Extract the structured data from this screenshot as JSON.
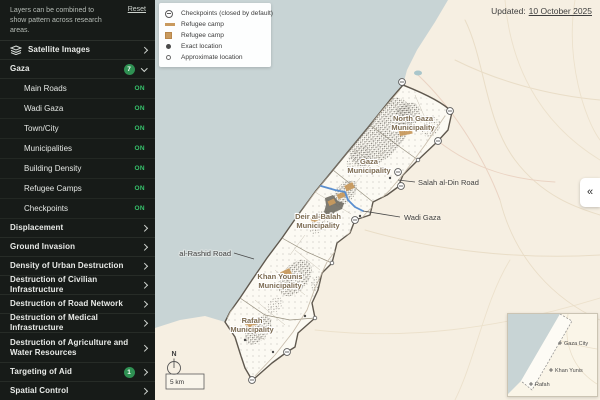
{
  "header": {
    "updated_prefix": "Updated:",
    "updated_date": "10 October 2025"
  },
  "sidebar": {
    "intro": "Layers can be combined to show pattern across research areas.",
    "reset": "Reset",
    "items": [
      {
        "label": "Satellite Images"
      },
      {
        "label": "Gaza",
        "badge": "7"
      },
      {
        "label": "Displacement"
      },
      {
        "label": "Ground Invasion"
      },
      {
        "label": "Density of Urban Destruction"
      },
      {
        "label": "Destruction of Civilian Infrastructure"
      },
      {
        "label": "Destruction of Road Network"
      },
      {
        "label": "Destruction of Medical Infrastructure"
      },
      {
        "label": "Destruction of Agriculture and Water Resources"
      },
      {
        "label": "Targeting of Aid",
        "badge": "1"
      },
      {
        "label": "Spatial Control"
      }
    ],
    "gaza_layers": [
      {
        "label": "Main Roads",
        "state": "ON"
      },
      {
        "label": "Wadi Gaza",
        "state": "ON"
      },
      {
        "label": "Town/City",
        "state": "ON"
      },
      {
        "label": "Municipalities",
        "state": "ON"
      },
      {
        "label": "Building Density",
        "state": "ON"
      },
      {
        "label": "Refugee Camps",
        "state": "ON"
      },
      {
        "label": "Checkpoints",
        "state": "ON"
      }
    ]
  },
  "legend": {
    "items": [
      {
        "icon": "checkpoint-closed-icon",
        "label": "Checkpoints (closed by default)"
      },
      {
        "icon": "refugee-camp-line-icon",
        "label": "Refugee camp"
      },
      {
        "icon": "refugee-camp-area-icon",
        "label": "Refugee camp"
      },
      {
        "icon": "exact-location-icon",
        "label": "Exact location"
      },
      {
        "icon": "approximate-location-icon",
        "label": "Approximate location"
      }
    ]
  },
  "map": {
    "municipalities": [
      {
        "line1": "North Gaza",
        "line2": "Municipality"
      },
      {
        "line1": "Gaza",
        "line2": "Municipality"
      },
      {
        "line1": "Deir al-Balah",
        "line2": "Municipality"
      },
      {
        "line1": "Khan Younis",
        "line2": "Municipality"
      },
      {
        "line1": "Rafah",
        "line2": "Municipality"
      }
    ],
    "annotations": {
      "salah": "Salah al-Din Road",
      "wadi": "Wadi Gaza",
      "rashid": "al-Rashid Road"
    },
    "compass": "N",
    "scale": "5 km",
    "collapse_icon": "«"
  },
  "inset": {
    "places": [
      "Gaza City",
      "Khan Yunis",
      "Rafah"
    ]
  },
  "colors": {
    "on_green": "#36c06a",
    "badge_green": "#2f9153",
    "camp_tan": "#c99a5e",
    "wadi_blue": "#5a8fd0",
    "sea": "#c8d4d5",
    "land": "#f6efe2"
  }
}
